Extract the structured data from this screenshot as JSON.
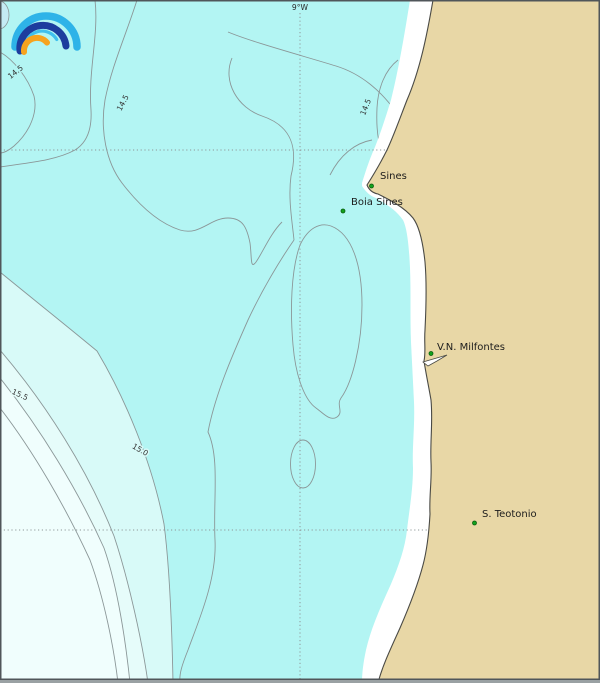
{
  "map": {
    "type": "sea-surface-temperature-contour-map",
    "region": "Portuguese coast near Sines",
    "grid": {
      "meridian_label": "9°W"
    },
    "places": [
      {
        "name": "Sines"
      },
      {
        "name": "Boia Sines"
      },
      {
        "name": "V.N. Milfontes"
      },
      {
        "name": "S. Teotonio"
      }
    ],
    "contour_labels": [
      {
        "value": "14.5"
      },
      {
        "value": "14.5"
      },
      {
        "value": "14.5"
      },
      {
        "value": "15.5"
      },
      {
        "value": "15.0"
      }
    ],
    "isotherm_levels": [
      "14.5",
      "15.0",
      "15.5"
    ],
    "palette": {
      "ocean": "#b3f5f3",
      "band_15_0_15_5": "#d8faf8",
      "band_15_5_plus": "#e6fcfa",
      "band_warmest": "#f0fefd",
      "cold_spot": "#c4ebf4",
      "land": "#e8d7a6",
      "coast_strip": "#ffffff",
      "contour_line": "#8b9798",
      "coastline": "#4a4a45",
      "grid_dots": "#8f9899",
      "marker_green": "#12a11c",
      "frame": "#50565a",
      "bottom_bar": "#9aa1a3",
      "logo_light_blue": "#2eb3e8",
      "logo_navy": "#1d3d9e",
      "logo_orange": "#f6a31f"
    }
  }
}
